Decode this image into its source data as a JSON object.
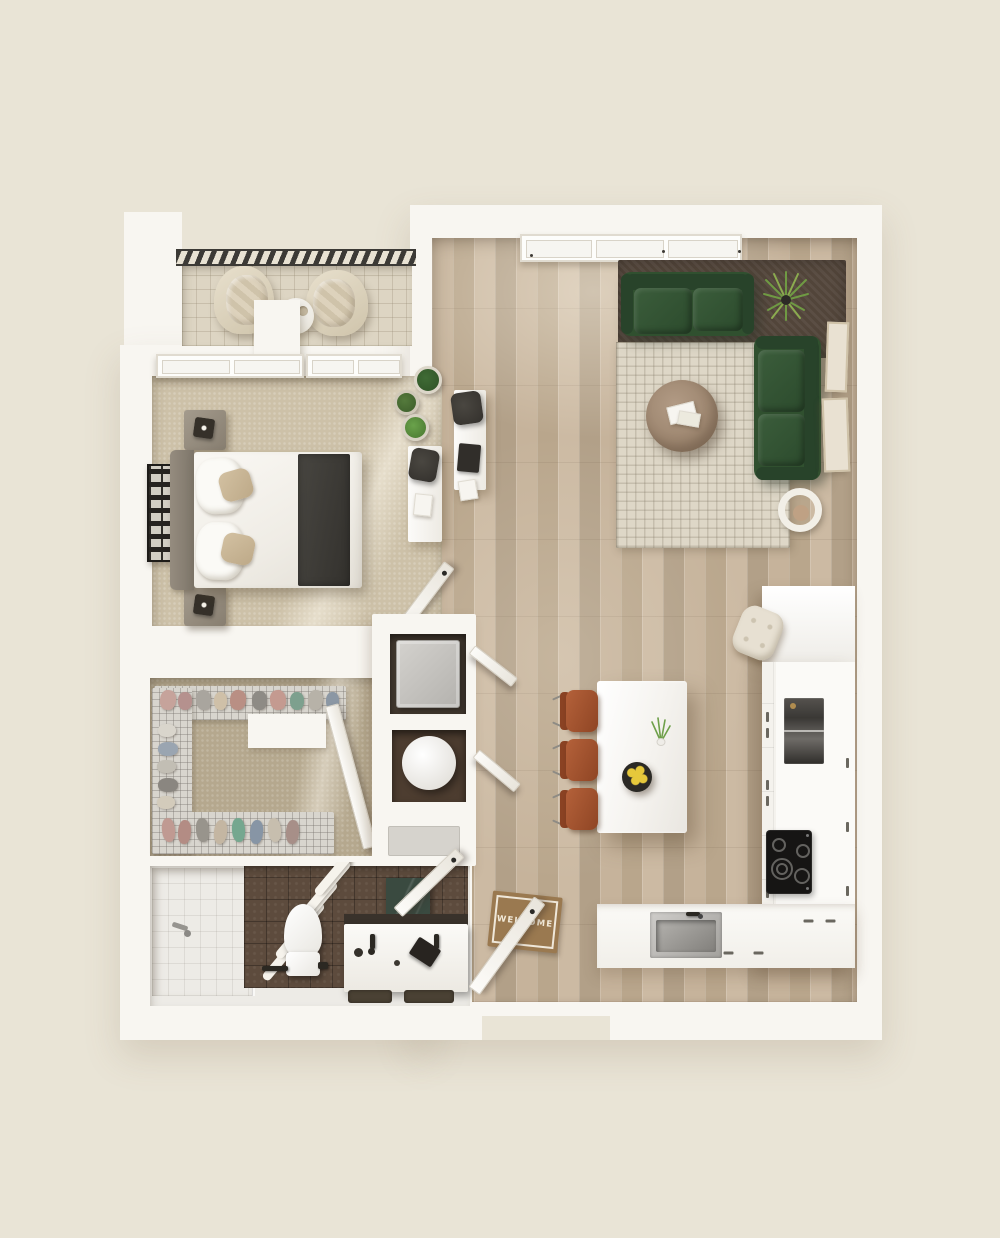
{
  "floorplan": {
    "entry_mat": {
      "text": "WELCOME"
    },
    "colors": {
      "background": "#e9e4d6",
      "wall": "#f8f6f1",
      "wood_floor": "#bda98f",
      "carpet": "#cdc1a8",
      "closet_floor": "#b5a88e",
      "balcony_tile": "#ddd5c3",
      "railing": "#3c3a36",
      "sofa_green": "#30502f",
      "sofa_green_dark": "#28432a",
      "rug_cream": "#ded7c7",
      "rug_dark": "#52453a",
      "coffee_table_wood": "#8d765f",
      "terracotta": "#8f4524",
      "tile_dark_brown": "#5d4b3d",
      "marble_green": "#3a4a40",
      "appliance_black": "#161514",
      "steel": "#a3a19d",
      "mat_brown": "#9a7950",
      "mat_text": "#f2ead9",
      "plant_green": "#6f9a43",
      "lemon_yellow": "#e6c83b"
    }
  }
}
